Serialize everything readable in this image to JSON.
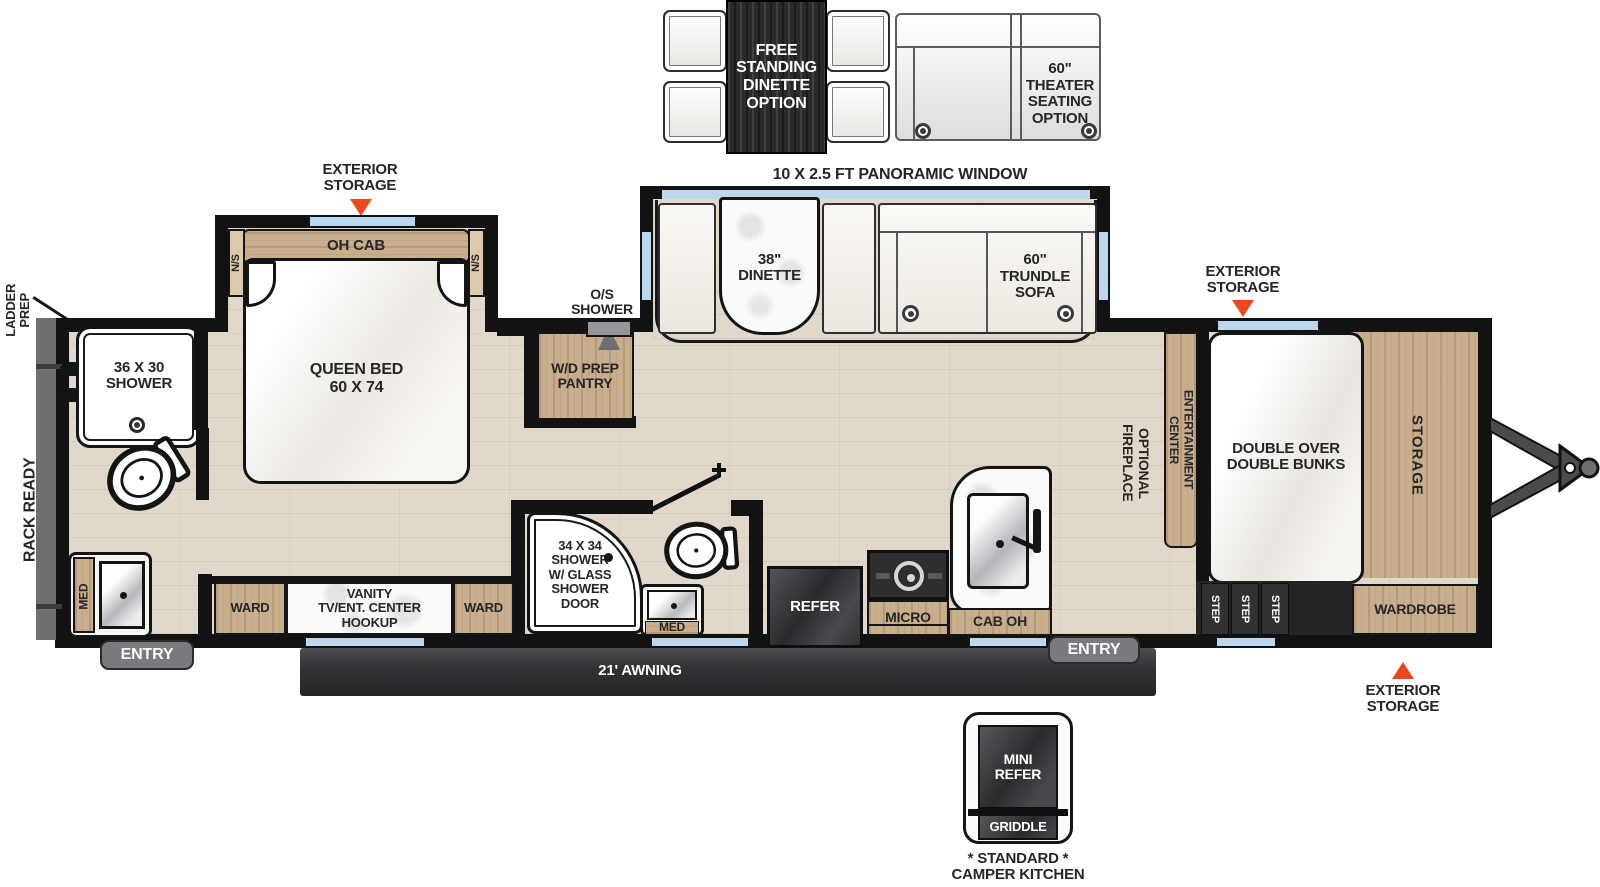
{
  "title": "Travel Trailer Floor Plan",
  "colors": {
    "accent": "#E8491F",
    "wood": "#C9AE8E",
    "floor": "#E0D9CB",
    "wall": "#121212",
    "window": "#BCD7EB",
    "awning": "#3B3B3E",
    "gray_fixture": "#797A7D"
  },
  "options": {
    "free_standing_dinette": "FREE\nSTANDING\nDINETTE\nOPTION",
    "theater_seating": "60\"\nTHEATER\nSEATING\nOPTION",
    "camper_kitchen_mini_refer": "MINI\nREFER",
    "camper_kitchen_griddle": "GRIDDLE",
    "camper_kitchen_caption": "* STANDARD *\nCAMPER KITCHEN"
  },
  "exterior": {
    "panoramic_window": "10 X 2.5 FT PANORAMIC WINDOW",
    "exterior_storage": "EXTERIOR\nSTORAGE",
    "ladder_prep": "LADDER\nPREP",
    "rack_ready": "RACK READY",
    "awning": "21' AWNING",
    "entry": "ENTRY"
  },
  "rooms": {
    "front_bath": {
      "shower": "36 X 30\nSHOWER",
      "med": "MED"
    },
    "bedroom": {
      "oh_cab": "OH CAB",
      "ns": "N/S",
      "queen_bed": "QUEEN BED\n60 X 74",
      "ward": "WARD",
      "vanity": "VANITY\nTV/ENT. CENTER\nHOOKUP"
    },
    "utility": {
      "os_shower": "O/S\nSHOWER",
      "wd_pantry": "W/D PREP\nPANTRY"
    },
    "mid_bath": {
      "shower": "34 X 34\nSHOWER\nW/ GLASS\nSHOWER\nDOOR",
      "med": "MED"
    },
    "living": {
      "dinette": "38\"\nDINETTE",
      "trundle_sofa": "60\"\nTRUNDLE\nSOFA",
      "entertainment_center": "ENTERTAINMENT\nCENTER",
      "optional_fireplace": "OPTIONAL\nFIREPLACE"
    },
    "kitchen": {
      "refer": "REFER",
      "micro": "MICRO",
      "cab_oh": "CAB OH"
    },
    "bunk_room": {
      "bunks": "DOUBLE OVER\nDOUBLE BUNKS",
      "storage": "STORAGE",
      "wardrobe": "WARDROBE",
      "step": "STEP"
    }
  }
}
